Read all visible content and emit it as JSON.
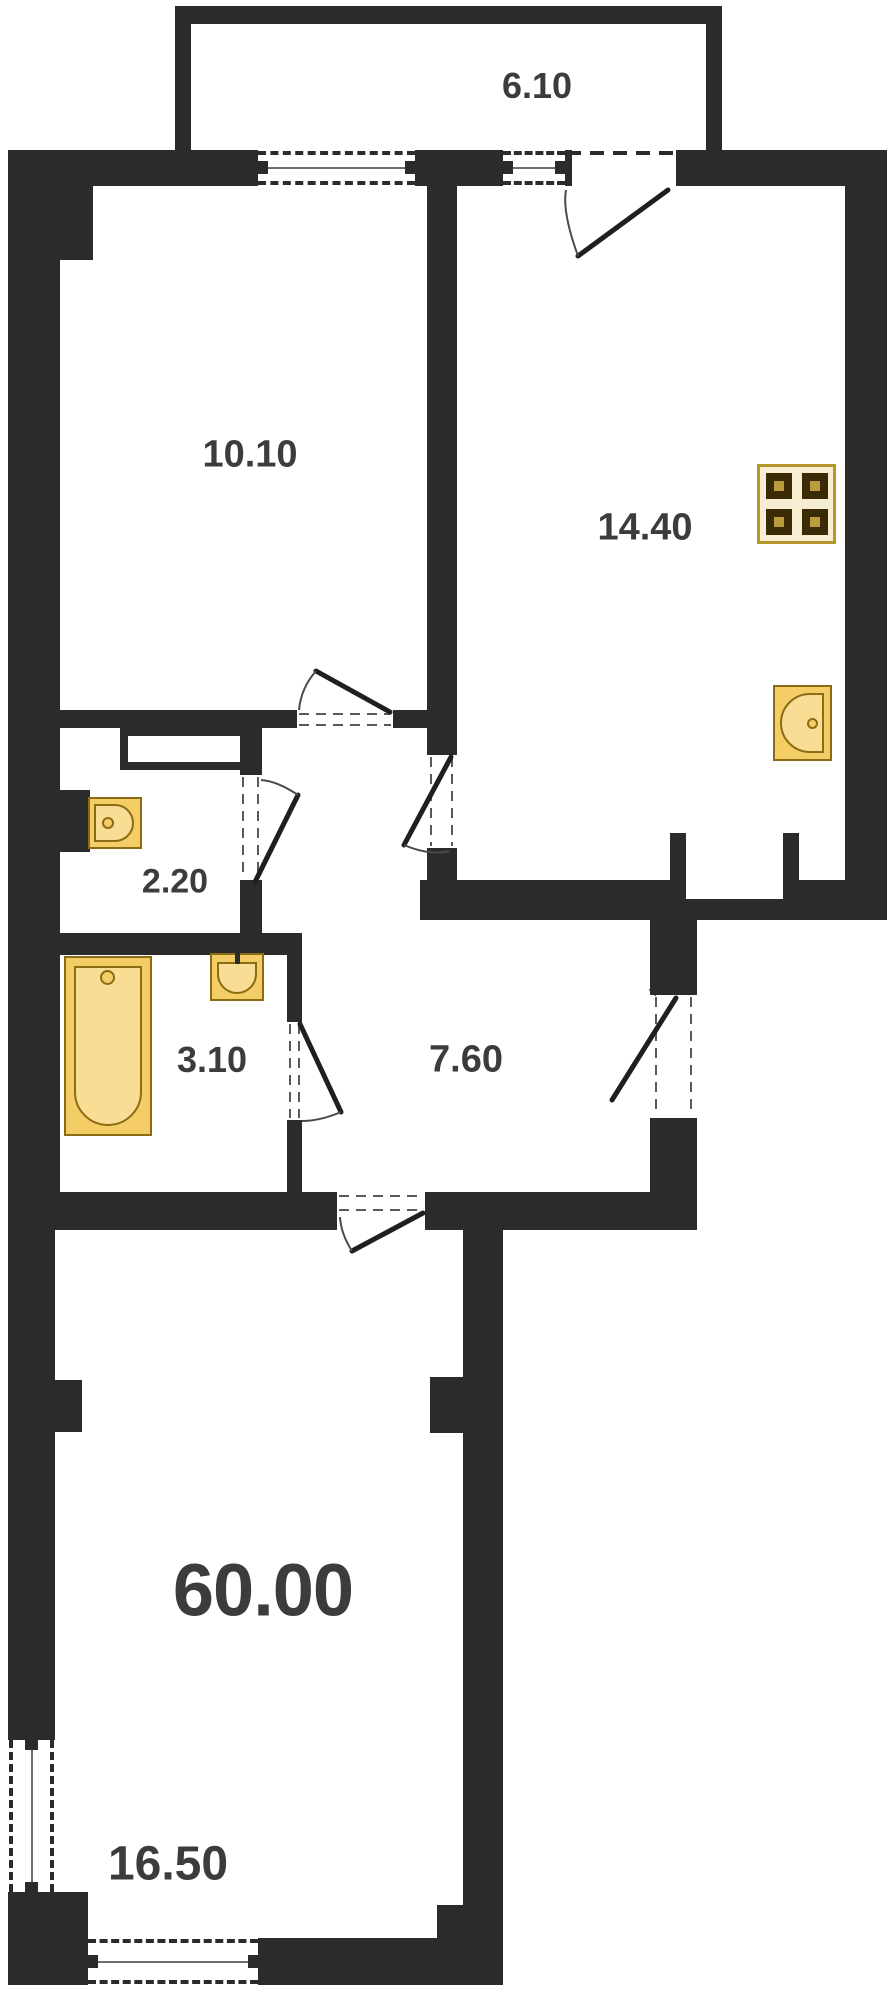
{
  "title": "Apartment floor plan",
  "labels": {
    "balcony": "6.10",
    "bedroom": "10.10",
    "kitchen": "14.40",
    "toilet": "2.20",
    "bathroom": "3.10",
    "hallway": "7.60",
    "total_area": "60.00",
    "living_room": "16.50"
  },
  "fixtures": {
    "stove": "stove-icon",
    "kitchen_sink": "kitchen-sink-icon",
    "toilet_sink": "toilet-sink-icon",
    "bathtub": "bathtub-icon",
    "bathroom_sink": "bathroom-sink-icon"
  },
  "colors": {
    "wall": "#2b2b2b",
    "bg": "#ffffff",
    "gold": "#f5cd66",
    "gold-dark": "#8a6c14",
    "gold-light": "#f9dd94",
    "stove-bg": "#f6edd2",
    "stove-border": "#b5962c",
    "burner": "#3b2a06",
    "burner-inner": "#bb9c3a",
    "label": "#3c3c3c"
  }
}
